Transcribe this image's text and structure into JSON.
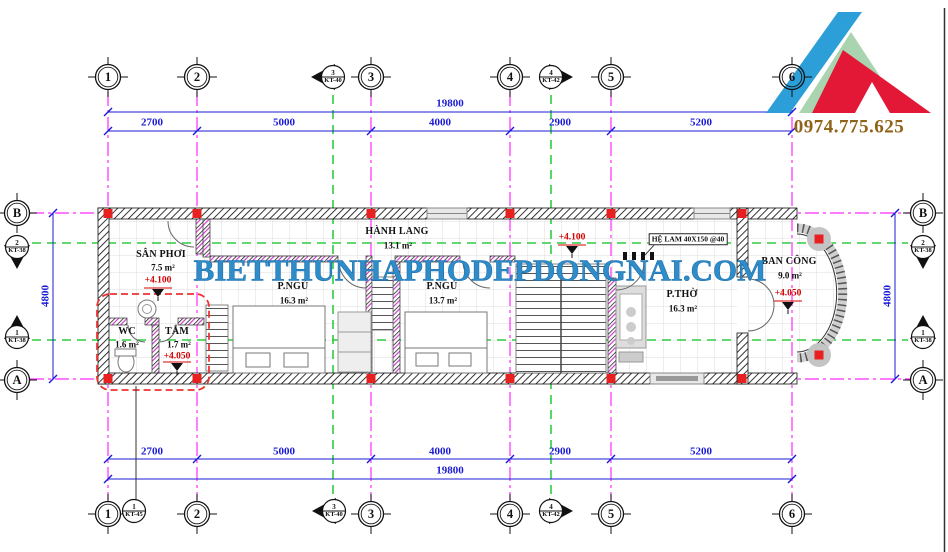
{
  "watermark": "BIETTHUNHAPHODEPDONGNAI.COM",
  "phone": "0974.775.625",
  "grid_bubbles": {
    "cols": [
      "1",
      "2",
      "3",
      "4",
      "5",
      "6"
    ],
    "rows": [
      "A",
      "B"
    ]
  },
  "dimensions": {
    "total_h": "19800",
    "segments_h": [
      "2700",
      "5000",
      "4000",
      "2900",
      "5200"
    ],
    "total_v": "4800"
  },
  "section_markers": {
    "kt40": {
      "num": "3",
      "sheet": "KT-40"
    },
    "kt42": {
      "num": "4",
      "sheet": "KT-42"
    },
    "kt45": {
      "num": "1",
      "sheet": "KT-45"
    },
    "kt38_b": {
      "num": "2",
      "sheet": "KT-38"
    },
    "kt38_a": {
      "num": "1",
      "sheet": "KT-38"
    }
  },
  "rooms": {
    "san_phoi": {
      "name": "SÂN PHƠI",
      "area": "7.5 m²",
      "level": "+4.100"
    },
    "wc": {
      "name": "WC",
      "area": "1.6 m²"
    },
    "tam": {
      "name": "TẮM",
      "area": "1.7 m²",
      "level": "+4.050"
    },
    "bed1": {
      "name": "P.NGỦ",
      "area": "16.3 m²"
    },
    "hanh_lang": {
      "name": "HÀNH LANG",
      "area": "13.1 m²"
    },
    "bed2": {
      "name": "P.NGỦ",
      "area": "13.7 m²"
    },
    "tho": {
      "name": "P.THỜ",
      "area": "16.3 m²",
      "level": "+4.100"
    },
    "balcony": {
      "name": "BAN CÔNG",
      "area": "9.0 m²",
      "level": "+4.050"
    }
  },
  "annotations": {
    "lam": "HỆ LAM 40X150 @40"
  },
  "colors": {
    "grid": "#ff2bff",
    "section_line": "#2ecc40",
    "dimension": "#1b1bd6",
    "level": "#d40000",
    "column": "#e82020",
    "wall": "#111111",
    "watermark": "#2e8cc8",
    "phone": "#8f6318",
    "logo_blue": "#2d9fd8",
    "logo_green": "#a9d4af",
    "logo_red": "#e31837"
  }
}
